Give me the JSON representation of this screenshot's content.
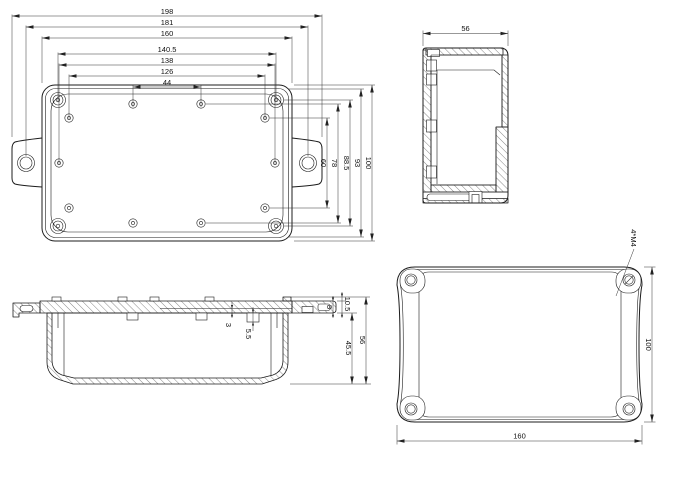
{
  "drawing": {
    "colors": {
      "background": "#ffffff",
      "line": "#1c1c1c",
      "dim": "#333333"
    },
    "views": {
      "plan": {
        "h_dims": [
          "198",
          "181",
          "160",
          "140.5",
          "138",
          "126",
          "44"
        ],
        "v_dims": [
          "60",
          "78",
          "88.5",
          "93",
          "100"
        ]
      },
      "end_section": {
        "width": "56"
      },
      "side_section": {
        "lip": "3",
        "boss_depth": "5.5",
        "flange_thickness": "8",
        "flange_height": "10.5",
        "body_depth": "45.5",
        "overall": "56"
      },
      "lid": {
        "screw_note": "4*M4",
        "height": "100",
        "width": "160"
      }
    }
  }
}
